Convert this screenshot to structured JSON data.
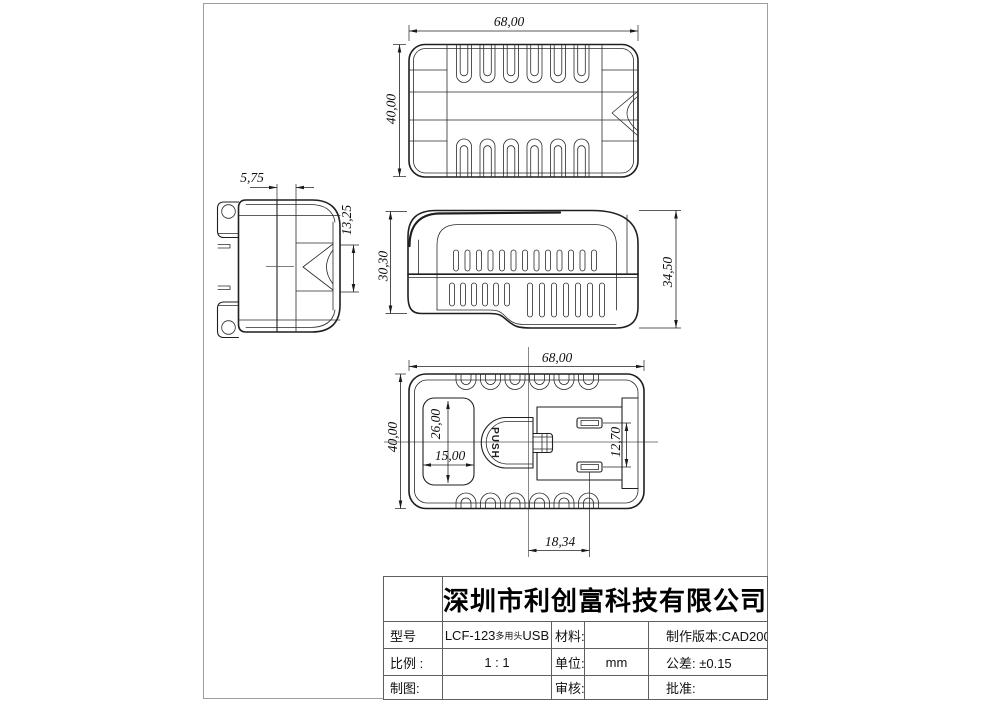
{
  "drawing": {
    "line_color": "#1f1f1f",
    "frame_color": "#9e9e9e",
    "views": {
      "top": {
        "width": "68,00",
        "height": "40,00"
      },
      "side": {
        "plug_offset": "5,75",
        "port_height": "13,25"
      },
      "front": {
        "front_height": "30,30",
        "overall_height": "34,50"
      },
      "bottom": {
        "width": "68,00",
        "height": "40,00",
        "recess_height": "26,00",
        "recess_width": "15,00",
        "contact_pitch": "12,70",
        "port_offset": "18,34",
        "button_label": "PUSH"
      }
    },
    "title_block": {
      "company": "深圳市利创富科技有限公司",
      "model_label": "型号",
      "model_value_prefix": "LCF-123",
      "model_value_small": "多用头",
      "model_value_suffix": "USB",
      "material_label": "材料:",
      "material_value": "",
      "version_label": "制作版本:CAD2008",
      "scale_label": "比例 :",
      "scale_value": "1 : 1",
      "unit_label": "单位:",
      "unit_value": "mm",
      "tolerance_label": "公差: ±0.15",
      "draft_label": "制图:",
      "draft_value": "",
      "check_label": "审核:",
      "check_value": "",
      "approve_label": "批准:",
      "approve_value": ""
    }
  }
}
